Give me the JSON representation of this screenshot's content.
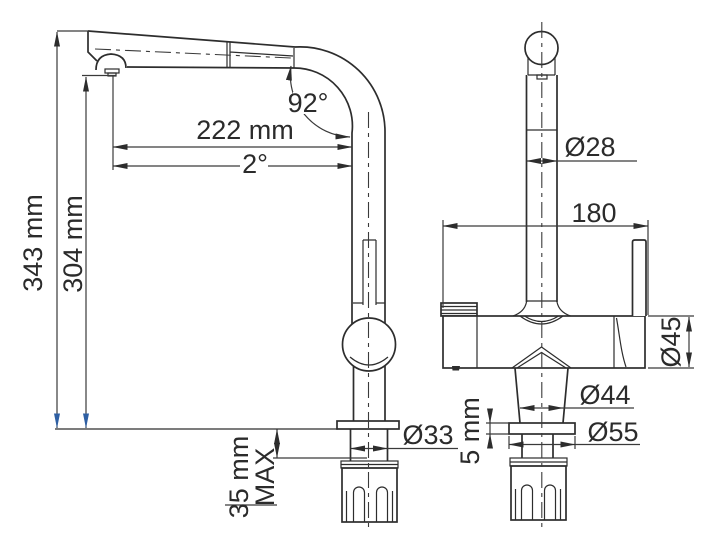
{
  "drawing": {
    "colors": {
      "line": "#2d2d2d",
      "arrow_blue": "#2e5fa3",
      "background": "#ffffff"
    },
    "side_view": {
      "dims": {
        "overall_height": "343 mm",
        "outlet_height": "304 mm",
        "reach": "222 mm",
        "tilt_angle": "2°",
        "bend_angle": "92°",
        "shank_diameter": "Ø33",
        "counter_thickness_line1": "35 mm",
        "counter_thickness_line2": "MAX"
      }
    },
    "front_view": {
      "dims": {
        "column_diameter": "Ø28",
        "body_length": "180",
        "body_diameter": "Ø45",
        "cone_diameter": "Ø44",
        "flange_diameter": "Ø55",
        "flange_thickness": "5 mm"
      }
    }
  }
}
